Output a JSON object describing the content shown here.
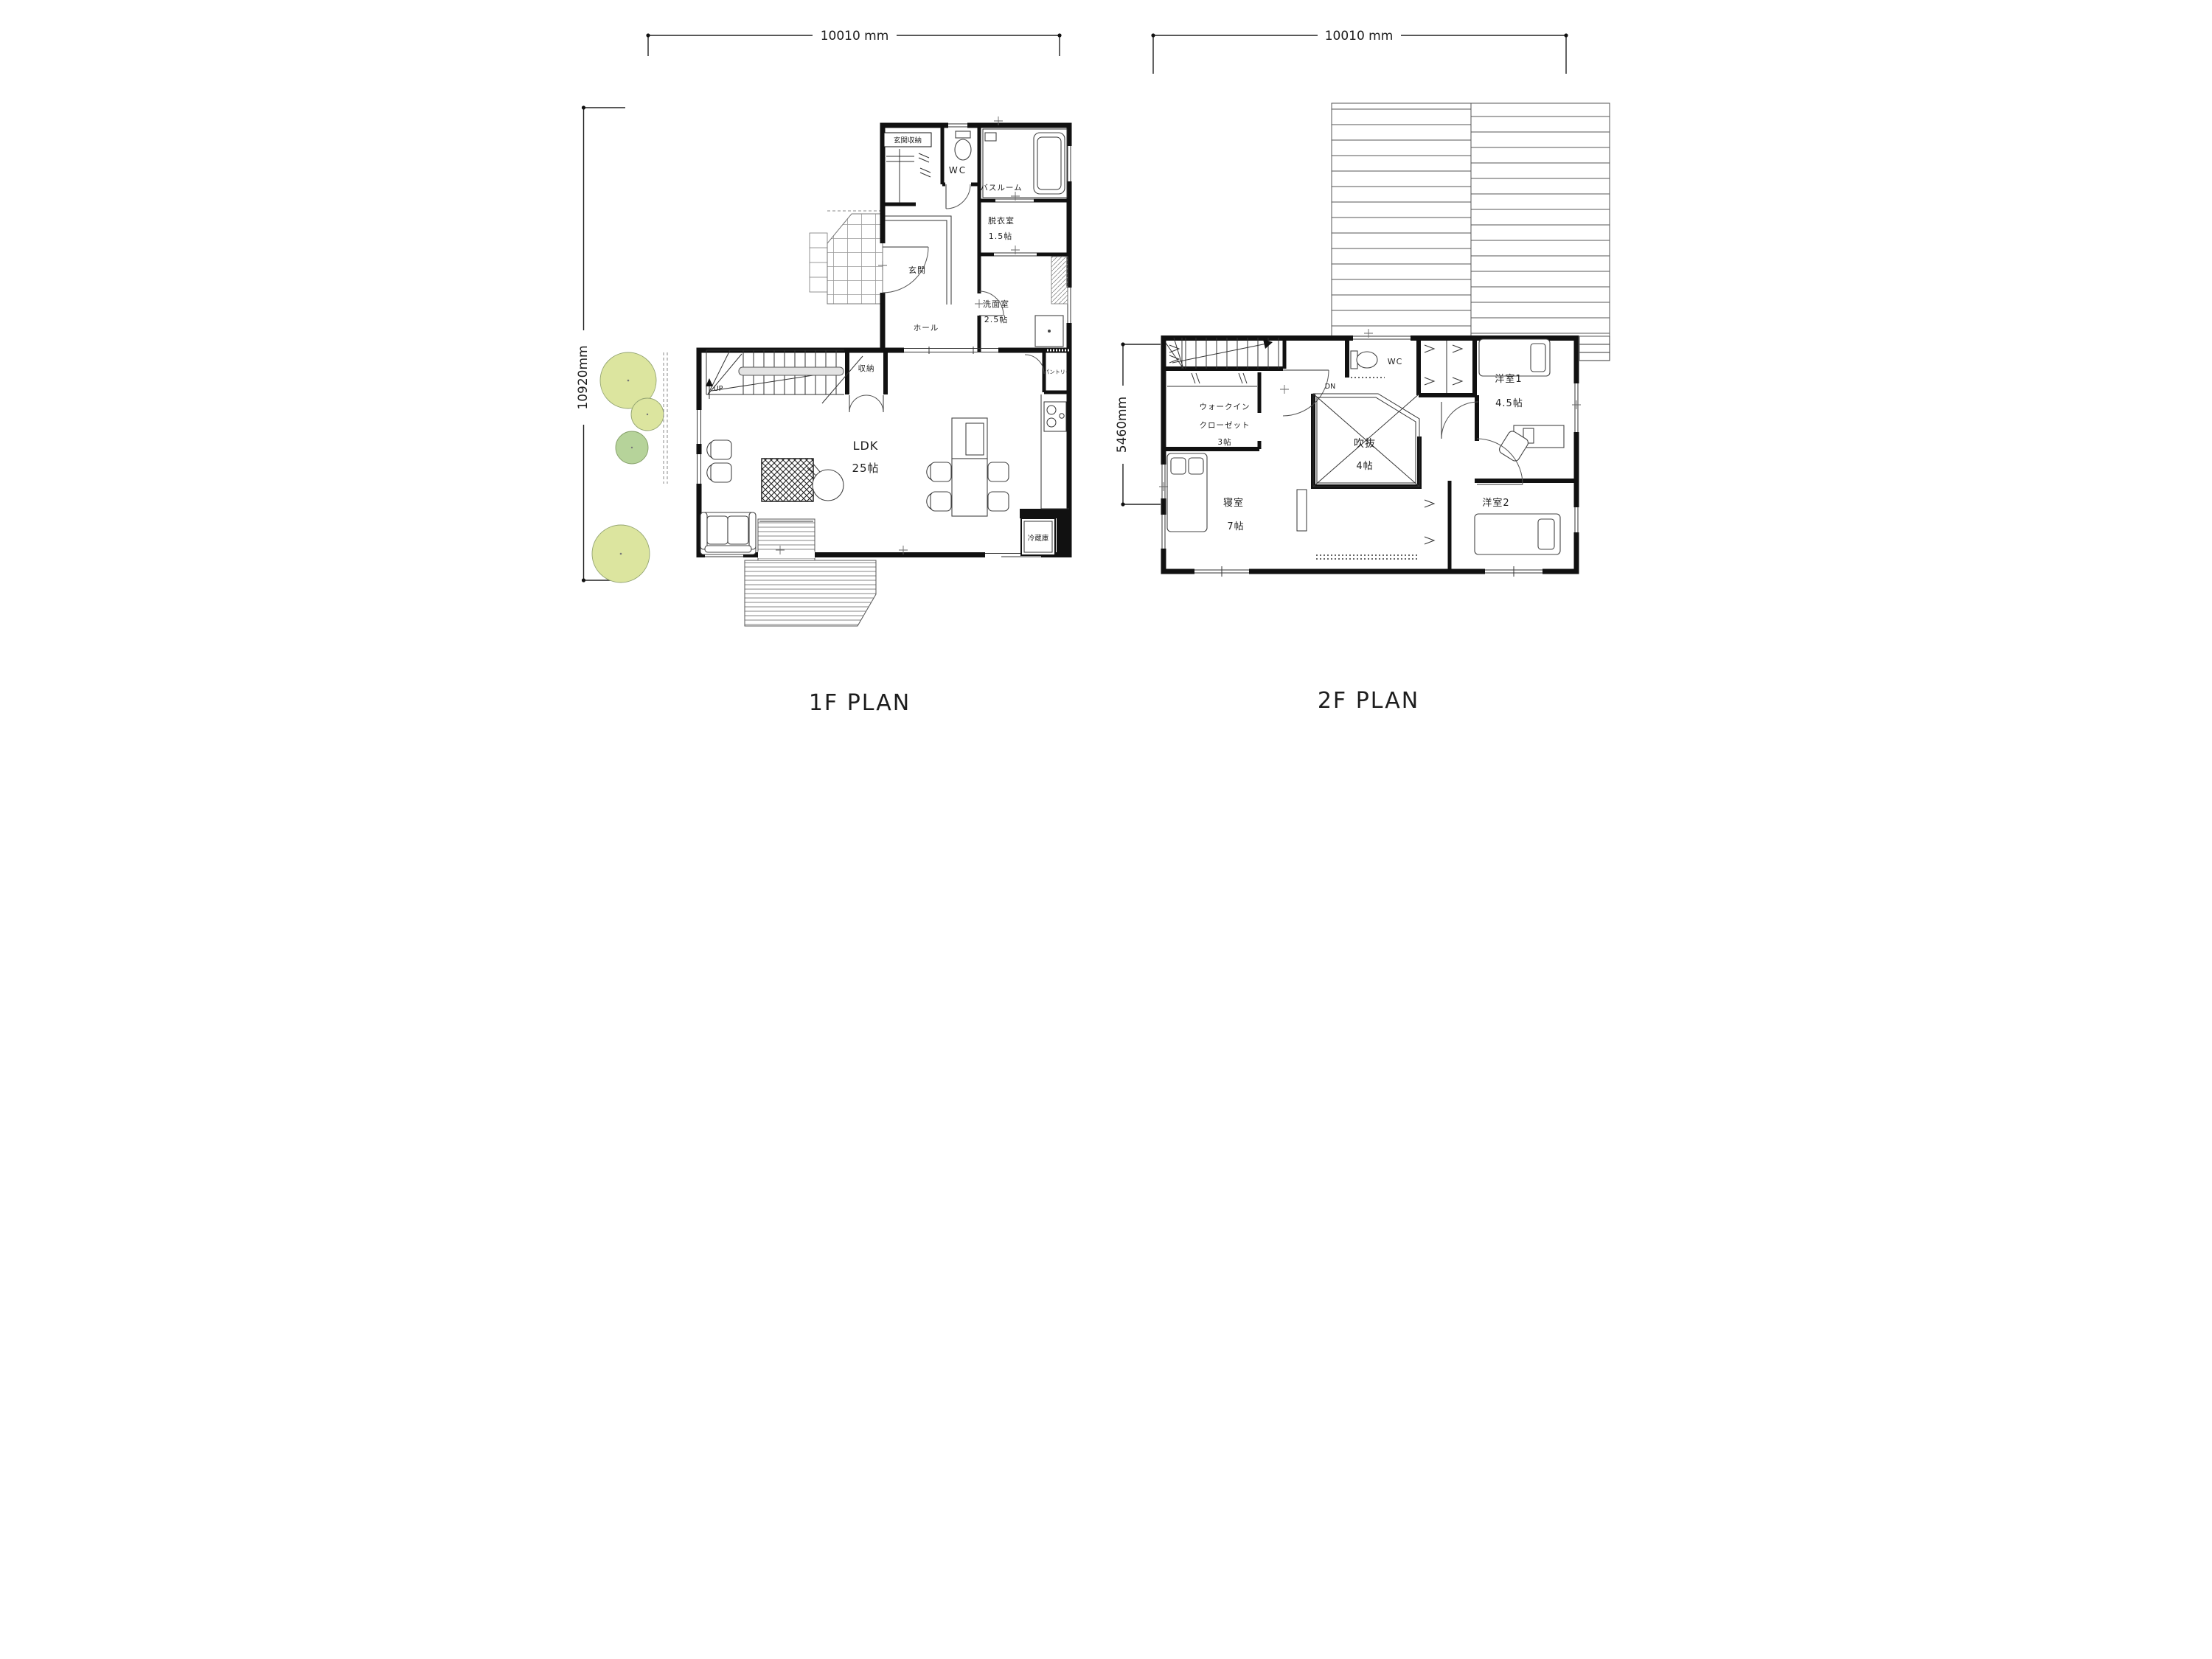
{
  "f1": {
    "title": "1F PLAN",
    "width_dim": "10010 mm",
    "height_dim": "10920mm",
    "entrance_storage": "玄関収納",
    "wc": "WC",
    "bathroom": "バスルーム",
    "dressing_room": "脱衣室",
    "dressing_size": "1.5帖",
    "entrance": "玄関",
    "washroom": "洗面室",
    "washroom_size": "2.5帖",
    "hall": "ホール",
    "storage": "収納",
    "pantry": "パントリー",
    "ldk": "LDK",
    "ldk_size": "25帖",
    "stairs": "UP",
    "refrigerator": "冷蔵庫"
  },
  "f2": {
    "title": "2F PLAN",
    "width_dim": "10010 mm",
    "height_dim": "5460mm",
    "wic_line1": "ウォークイン",
    "wic_line2": "クローゼット",
    "wic_size": "3帖",
    "bedroom": "寝室",
    "bedroom_size": "7帖",
    "atrium": "吹抜",
    "atrium_size": "4帖",
    "wc": "WC",
    "stairs": "DN",
    "room1": "洋室1",
    "room1_size": "4.5帖",
    "room2": "洋室2",
    "room2_size": "5帖"
  },
  "colors": {
    "wall": "#111111",
    "tree_light": "#dce59f",
    "tree_green": "#b6d39a",
    "roof_line": "#555555"
  }
}
